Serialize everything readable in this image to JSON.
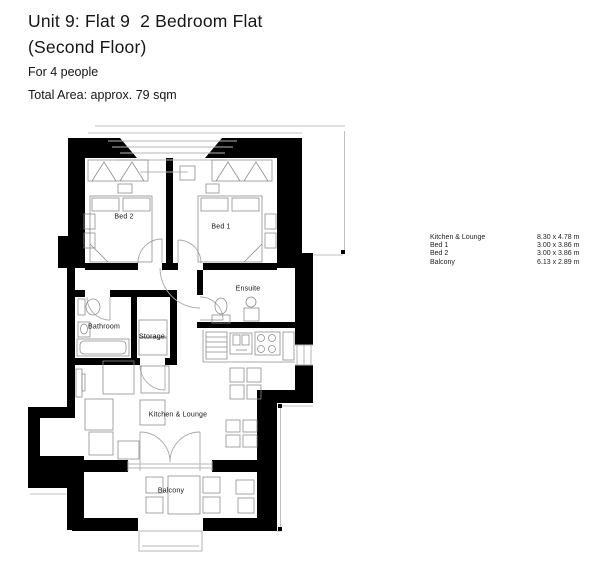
{
  "header": {
    "title_line1": "Unit 9: Flat 9  2 Bedroom Flat",
    "title_line2": "(Second Floor)",
    "occupancy": "For 4 people",
    "total_area": "Total Area: approx. 79 sqm"
  },
  "dimensions_table": {
    "rows": [
      {
        "room": "Kitchen & Lounge",
        "size": "8.30 x 4.78 m"
      },
      {
        "room": "Bed 1",
        "size": "3.00 x 3.86 m"
      },
      {
        "room": "Bed 2",
        "size": "3.00 x 3.86 m"
      },
      {
        "room": "Balcony",
        "size": "6.13 x 2.89 m"
      }
    ]
  },
  "floor_plan": {
    "wall_color": "#000000",
    "line_color": "#b4b4b4",
    "furniture_color": "#8e8e8e",
    "rooms": [
      {
        "label": "Bed 2"
      },
      {
        "label": "Bed 1"
      },
      {
        "label": "Ensuite"
      },
      {
        "label": "Bathroom"
      },
      {
        "label": "Storage"
      },
      {
        "label": "Kitchen & Lounge"
      },
      {
        "label": "Balcony"
      }
    ]
  }
}
